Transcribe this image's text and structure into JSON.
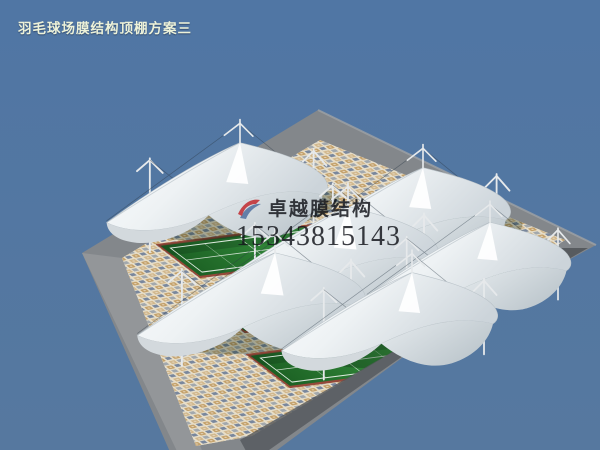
{
  "title": "羽毛球场膜结构顶棚方案三",
  "watermark": {
    "brand": "卓越膜结构",
    "phone": "15343815143"
  },
  "scene": {
    "type": "3d-architectural-render",
    "subject": "badminton court tensile membrane canopy roofs over green courts on a mosaic tile plaza",
    "canopy_count": 6,
    "court_strip_count": 3,
    "canopy_label": "tensile membrane canopy",
    "court_label": "badminton court",
    "plaza_label": "mosaic tile plaza"
  },
  "colors": {
    "background": "#54779f",
    "plaza_gray": "#83878b",
    "plaza_light": "#9a9da0",
    "plaza_dark": "#54585d",
    "tile_base": "#e7dec9",
    "tile_tan": "#bf9659",
    "tile_blue": "#5e7292",
    "court_green": "#2f8f3a",
    "court_green_dark": "#1c6124",
    "court_line": "#e8f0e8",
    "court_edge": "#96493a",
    "membrane_white": "#fbfdfe",
    "membrane_shade": "#ccd4da",
    "title_text": "#edf2d9",
    "watermark_text": "#14161c",
    "logo_red": "#c1272d",
    "logo_blue": "#3f6296"
  }
}
